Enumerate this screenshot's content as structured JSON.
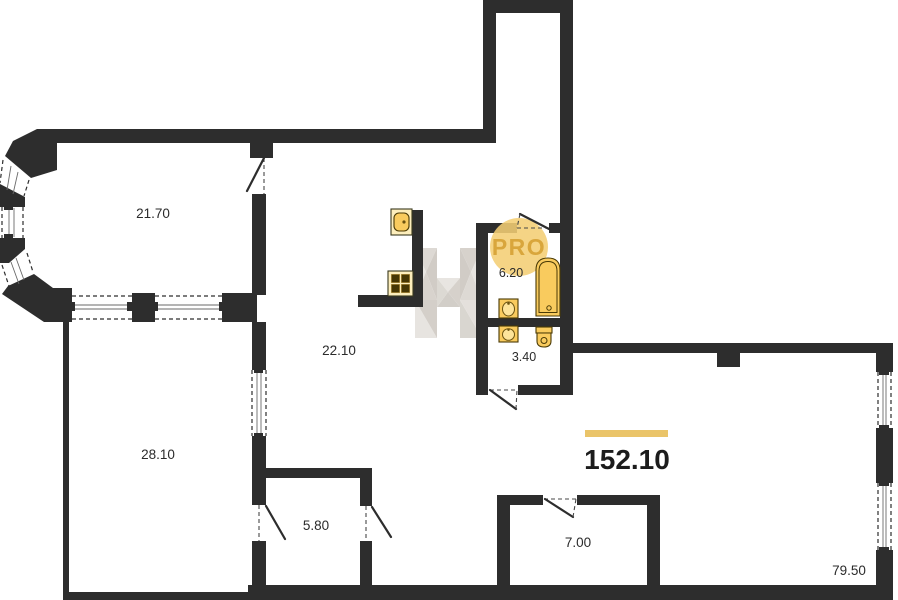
{
  "plan": {
    "kind": "apartment floor plan",
    "badge": {
      "label": "PRO"
    },
    "total": {
      "area": "152.10"
    },
    "rooms": [
      {
        "name": "bay-window-room",
        "area": "21.70"
      },
      {
        "name": "kitchen-living",
        "area": "22.10"
      },
      {
        "name": "bedroom",
        "area": "28.10"
      },
      {
        "name": "storage",
        "area": "5.80"
      },
      {
        "name": "bathroom",
        "area": "6.20"
      },
      {
        "name": "toilet",
        "area": "3.40"
      },
      {
        "name": "entry-closet",
        "area": "7.00"
      },
      {
        "name": "main-space",
        "area": "79.50"
      }
    ],
    "icons": [
      "kitchen-sink-icon",
      "stove-icon",
      "bathtub-icon",
      "washbasin-icon",
      "washbasin-icon",
      "toilet-icon",
      "watermark-logo-icon",
      "pro-badge"
    ]
  },
  "colors": {
    "wall": "#2d2d2d",
    "accent_bar": "#eac469",
    "fixture_fill": "#f9cb5e",
    "fixture_dark": "#4a3a05",
    "badge_fill": "#f4ce74",
    "badge_text": "#d9a63c",
    "label_text": "#2b2b2b",
    "total_text": "#1c1c1c"
  }
}
